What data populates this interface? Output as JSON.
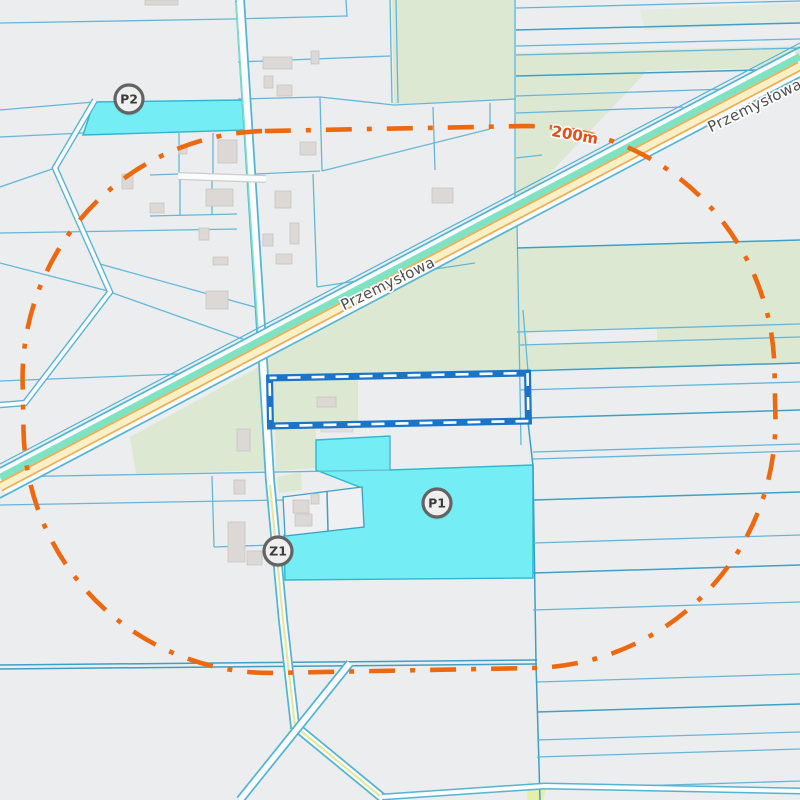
{
  "map": {
    "description": "cadastral-map-view",
    "markers": [
      {
        "id": "P2",
        "label": "P2",
        "x": 129,
        "y": 99
      },
      {
        "id": "Z1",
        "label": "Z1",
        "x": 278,
        "y": 551
      },
      {
        "id": "P1",
        "label": "P1",
        "x": 437,
        "y": 503
      }
    ],
    "labels": {
      "street_main": "Przemysłowa",
      "street_partial": "Przemysłowa",
      "buffer_distance": "200m"
    },
    "colors": {
      "background": "#ebedee",
      "green_area": "#dde8d2",
      "grass_yellow": "#e3efaa",
      "cyan_parcel": "#74edf4",
      "cyan_border": "#2cb8cf",
      "parcel_line": "#64b7d9",
      "parcel_line_dark": "#3ea0c6",
      "buffer_orange": "#ed6911",
      "selection_blue": "#1a74c8",
      "road_teal": "#54b4d3",
      "road_mint": "#7fe2c3",
      "road_yellow": "#f8f1c7",
      "road_orange": "#efae55",
      "road_white": "#fbfcfd",
      "building_fill": "#dbd8d5",
      "building_edge": "#c9c5c1",
      "white_parcel": "#eff0f1",
      "marker_fill": "#efefef",
      "marker_border": "#636363",
      "marker_text": "#3c3c3c",
      "street_text": "#4e4e4e",
      "distance_text": "#e2511a"
    }
  }
}
